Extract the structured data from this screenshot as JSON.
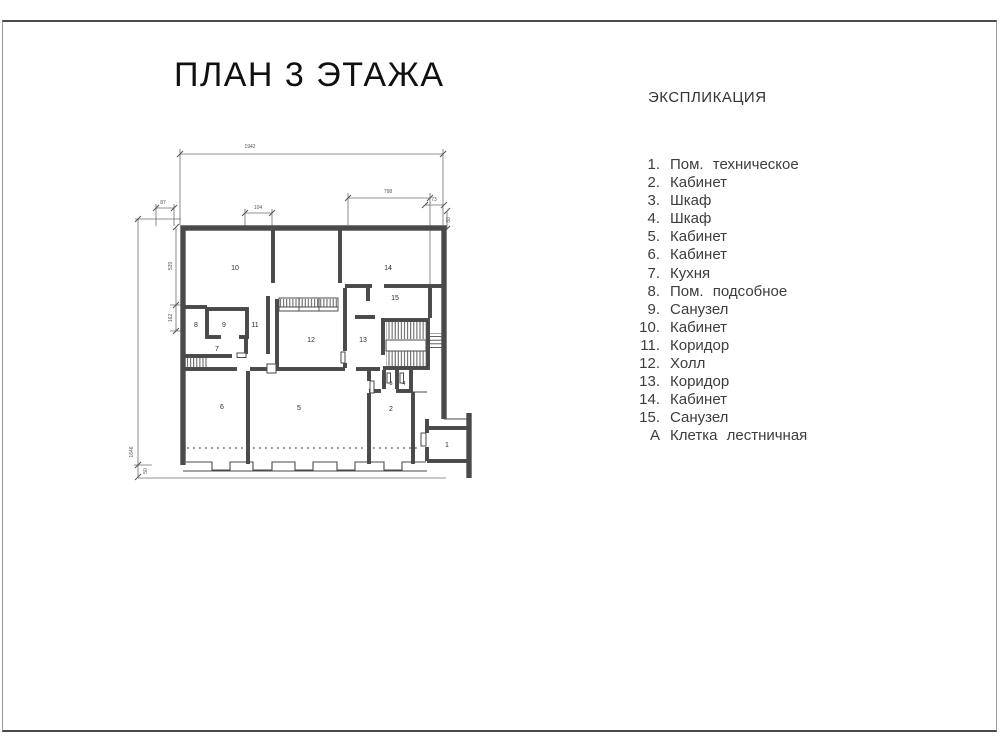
{
  "page": {
    "title": "ПЛАН 3 ЭТАЖА"
  },
  "legend": {
    "header": "ЭКСПЛИКАЦИЯ",
    "items": [
      {
        "num": "1.",
        "label": "Пом. техническое"
      },
      {
        "num": "2.",
        "label": "Кабинет"
      },
      {
        "num": "3.",
        "label": "Шкаф"
      },
      {
        "num": "4.",
        "label": "Шкаф"
      },
      {
        "num": "5.",
        "label": "Кабинет"
      },
      {
        "num": "6.",
        "label": "Кабинет"
      },
      {
        "num": "7.",
        "label": "Кухня"
      },
      {
        "num": "8.",
        "label": "Пом. подсобное"
      },
      {
        "num": "9.",
        "label": "Санузел"
      },
      {
        "num": "10.",
        "label": "Кабинет"
      },
      {
        "num": "11.",
        "label": "Коридор"
      },
      {
        "num": "12.",
        "label": "Холл"
      },
      {
        "num": "13.",
        "label": "Коридор"
      },
      {
        "num": "14.",
        "label": "Кабинет"
      },
      {
        "num": "15.",
        "label": "Санузел"
      },
      {
        "num": "А",
        "label": "Клетка лестничная"
      }
    ]
  },
  "plan": {
    "room_labels": [
      {
        "n": "1",
        "x": 447,
        "y": 447
      },
      {
        "n": "2",
        "x": 391,
        "y": 411
      },
      {
        "n": "3",
        "x": 391,
        "y": 385,
        "small": true
      },
      {
        "n": "4",
        "x": 404,
        "y": 385,
        "small": true
      },
      {
        "n": "5",
        "x": 299,
        "y": 410
      },
      {
        "n": "6",
        "x": 222,
        "y": 409
      },
      {
        "n": "7",
        "x": 217,
        "y": 351
      },
      {
        "n": "8",
        "x": 196,
        "y": 327
      },
      {
        "n": "9",
        "x": 224,
        "y": 327
      },
      {
        "n": "10",
        "x": 235,
        "y": 270
      },
      {
        "n": "11",
        "x": 255,
        "y": 327
      },
      {
        "n": "12",
        "x": 311,
        "y": 342
      },
      {
        "n": "13",
        "x": 363,
        "y": 342
      },
      {
        "n": "14",
        "x": 388,
        "y": 270
      },
      {
        "n": "15",
        "x": 395,
        "y": 300
      }
    ],
    "dimension_labels": [
      {
        "text": "1942",
        "x": 250,
        "y": 148
      },
      {
        "text": "87",
        "x": 163,
        "y": 204
      },
      {
        "text": "104",
        "x": 258,
        "y": 209
      },
      {
        "text": "798",
        "x": 388,
        "y": 193
      },
      {
        "text": "73",
        "x": 434,
        "y": 201
      },
      {
        "text": "30",
        "x": 450,
        "y": 220,
        "rot": -90
      },
      {
        "text": "539",
        "x": 172,
        "y": 266,
        "rot": -90
      },
      {
        "text": "162",
        "x": 172,
        "y": 318,
        "rot": -90
      },
      {
        "text": "1646",
        "x": 133,
        "y": 452,
        "rot": -90
      },
      {
        "text": "50",
        "x": 147,
        "y": 471,
        "rot": -90
      }
    ]
  },
  "colors": {
    "wall_line": "#4a4a4a",
    "dim_line": "#6e6e6e",
    "text": "#3d3d3d",
    "frame_border": "#4c4c4c",
    "background": "#ffffff"
  }
}
